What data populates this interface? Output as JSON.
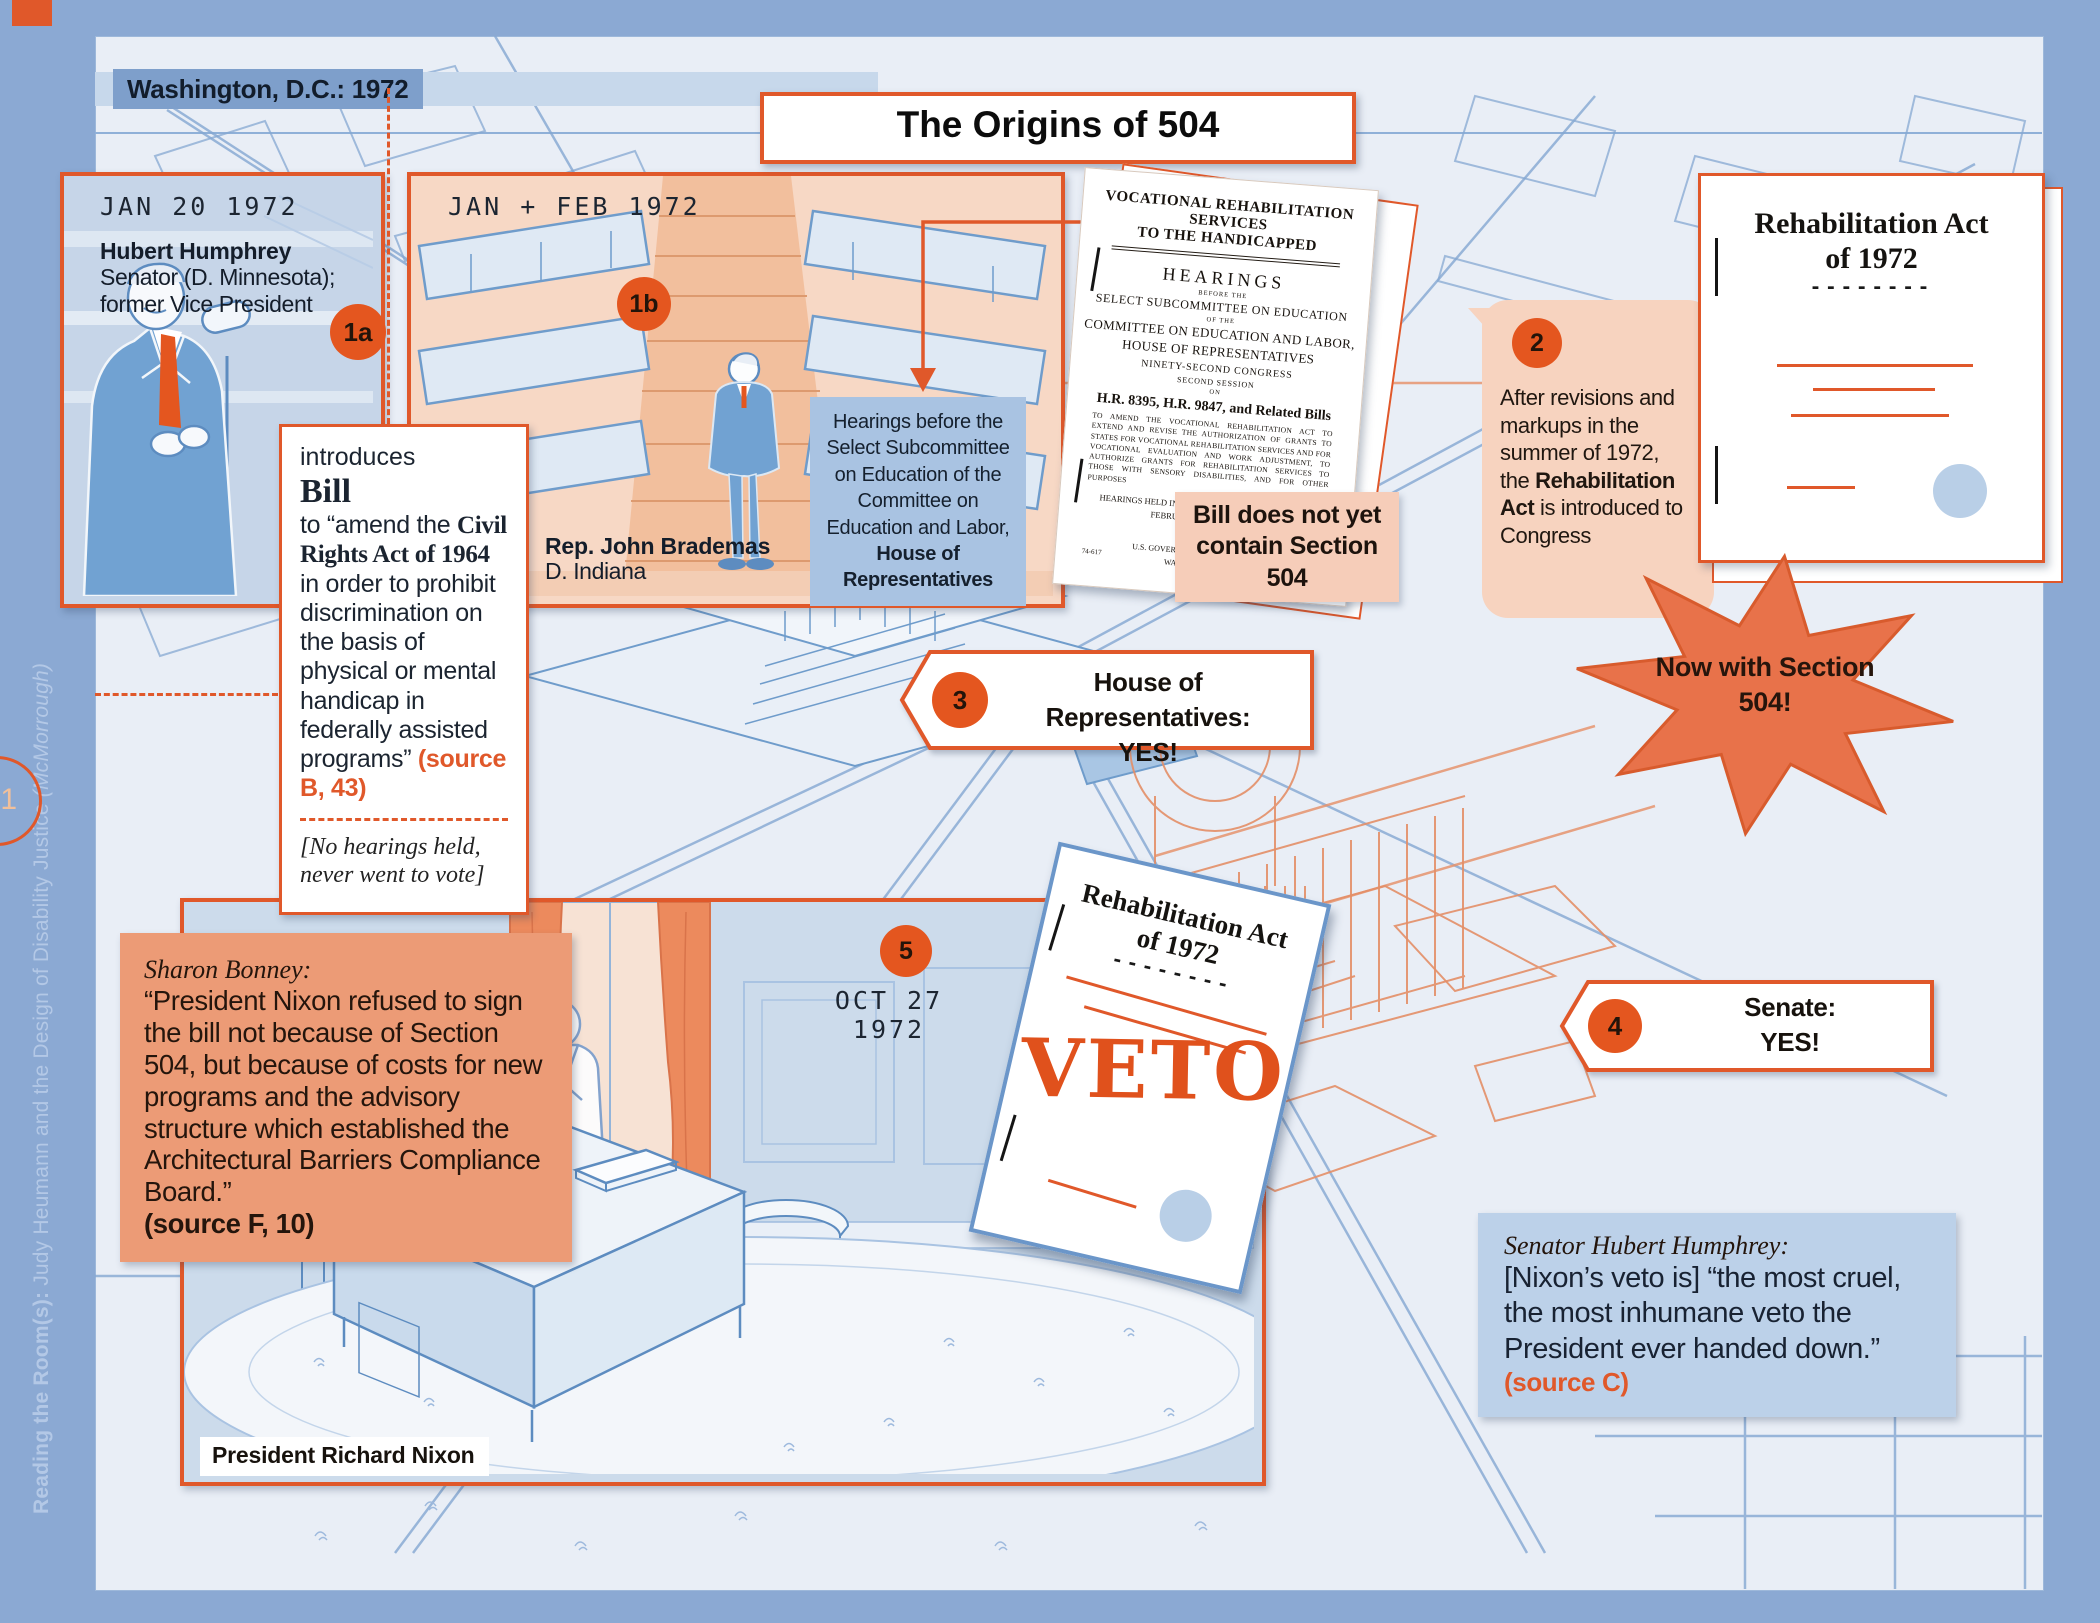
{
  "page": {
    "location_label": "Washington, D.C.: 1972",
    "title": "The Origins of 504",
    "side_title_bold": "Reading the Room(s): ",
    "side_title_main": "Judy Heumann and the Design of Disability Justice ",
    "side_title_paren": "(McMorrough)",
    "page_number": "1"
  },
  "step1a": {
    "badge": "1a",
    "date": "JAN 20 1972",
    "name": "Hubert Humphrey",
    "title": "Senator (D. Minnesota); former Vice President"
  },
  "bill_box": {
    "intro": "introduces",
    "heading": "Bill",
    "body_pre": "to “amend the ",
    "body_act": "Civil Rights Act of 1964",
    "body_post": " in order to prohibit discrimination on the basis of physical or mental handicap in federally assisted programs” ",
    "source": "(source B, 43)",
    "note": "[No hearings held, never went to vote]"
  },
  "step1b": {
    "badge": "1b",
    "date": "JAN + FEB 1972",
    "name": "Rep. John Brademas",
    "title": "D. Indiana",
    "note_pre": "Hearings before the Select Subcommittee on Education of the Committee on Education and Labor, ",
    "note_bold": "House of Representatives"
  },
  "hearings_doc": {
    "title_line1": "VOCATIONAL REHABILITATION SERVICES",
    "title_line2": "TO THE HANDICAPPED",
    "hearings": "HEARINGS",
    "before_the": "BEFORE THE",
    "subcommittee": "SELECT SUBCOMMITTEE ON EDUCATION",
    "of_the": "OF THE",
    "committee": "COMMITTEE ON EDUCATION AND LABOR,",
    "house": "HOUSE OF REPRESENTATIVES",
    "congress": "NINETY-SECOND CONGRESS",
    "session": "SECOND SESSION",
    "on_word": "ON",
    "bills": "H.R. 8395, H.R. 9847, and Related Bills",
    "summary": "TO AMEND THE VOCATIONAL REHABILITATION ACT TO EXTEND AND REVISE THE AUTHORIZATION OF GRANTS TO STATES FOR VOCATIONAL REHABILITATION SERVICES AND FOR VOCATIONAL EVALUATION AND WORK ADJUSTMENT, TO AUTHORIZE GRANTS FOR REHABILITATION SERVICES TO THOSE WITH SENSORY DISABILITIES, AND FOR OTHER PURPOSES",
    "held_line1": "HEARINGS HELD IN WASHINGTON, D.C., JANUARY 31;",
    "held_line2": "FEBRUARY 1, 2, AND 3, 1972",
    "printed": "Printed for the",
    "gpo_line1": "U.S. GOVERNMENT PRINTING OFFICE",
    "gpo_line2": "WASHINGTON : 1972",
    "doc_number": "74-617"
  },
  "note_504": {
    "line1": "Bill does not yet",
    "line2": "contain Section 504"
  },
  "step2": {
    "badge": "2",
    "text_pre": "After revisions and markups in the summer of 1972, the ",
    "text_bold": "Rehabilitation Act",
    "text_post": " is introduced to Congress"
  },
  "act_doc": {
    "title_line1": "Rehabilitation Act",
    "title_line2": "of 1972",
    "dashes": "--------"
  },
  "starburst": {
    "line1": "Now with Section",
    "line2": "504!"
  },
  "step3": {
    "badge": "3",
    "line1": "House of Representatives:",
    "line2": "YES!"
  },
  "step4": {
    "badge": "4",
    "line1": "Senate:",
    "line2": "YES!"
  },
  "step5": {
    "badge": "5",
    "date": "OCT 27 1972",
    "person_label": "President Richard Nixon"
  },
  "veto_doc": {
    "title_line1": "Rehabilitation Act",
    "title_line2": "of 1972",
    "dashes": "--------",
    "stamp": "VETO"
  },
  "bonney_quote": {
    "attribution": "Sharon Bonney:",
    "text": "“President Nixon refused to sign the bill not because of Section 504, but because of costs for new programs and the advisory structure which established the Architectural Barriers Compliance Board.”",
    "source": "(source F, 10)"
  },
  "humphrey_quote": {
    "attribution": "Senator Hubert Humphrey:",
    "text": "[Nixon’s veto is] “the most cruel, the most inhumane veto the President ever handed down.”",
    "source": "(source C)"
  },
  "colors": {
    "accent_orange": "#e0582a",
    "badge_orange": "#e4561f",
    "panel_blue": "#c6d5e8",
    "panel_peach": "#f7d8c5",
    "quote_salmon": "#ec9b76",
    "quote_blue": "#bcd1e9",
    "doc_border_blue": "#6b96c9",
    "veto_orange": "#e0511c"
  }
}
